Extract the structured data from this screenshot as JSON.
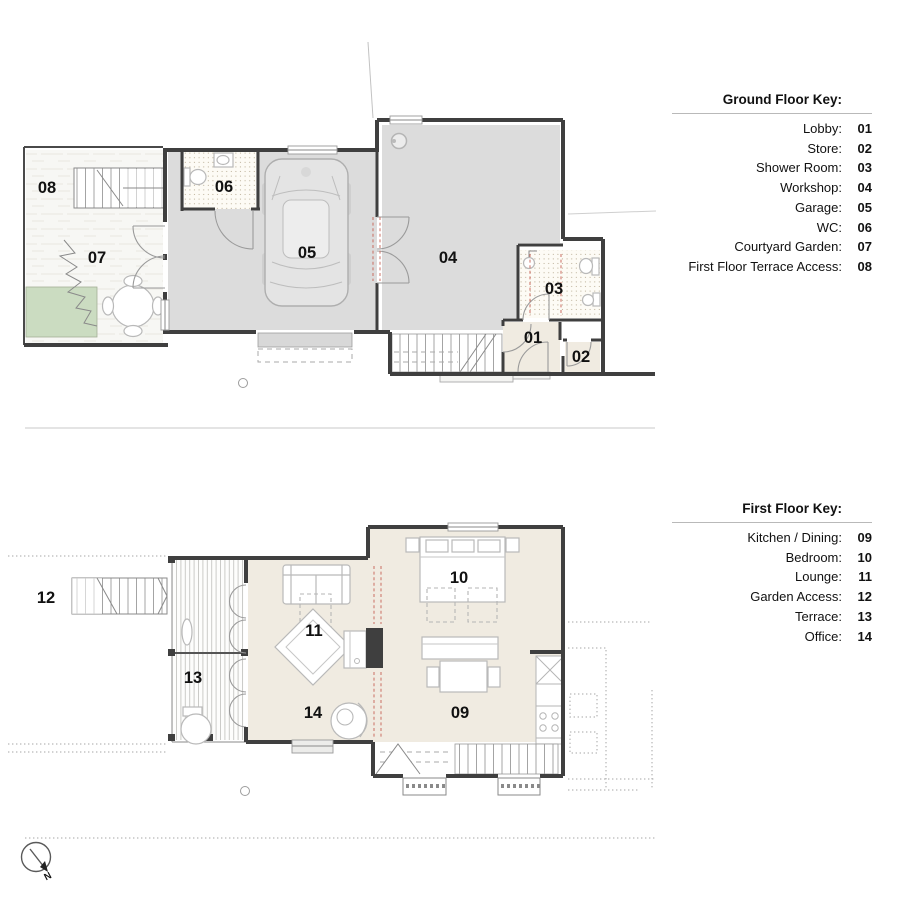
{
  "ground_floor": {
    "key_title": "Ground Floor Key:",
    "key": [
      {
        "label": "Lobby:",
        "number": "01"
      },
      {
        "label": "Store:",
        "number": "02"
      },
      {
        "label": "Shower Room:",
        "number": "03"
      },
      {
        "label": "Workshop:",
        "number": "04"
      },
      {
        "label": "Garage:",
        "number": "05"
      },
      {
        "label": "WC:",
        "number": "06"
      },
      {
        "label": "Courtyard Garden:",
        "number": "07"
      },
      {
        "label": "First Floor Terrace Access:",
        "number": "08"
      }
    ],
    "plan_labels": {
      "lobby": "01",
      "store": "02",
      "shower_room": "03",
      "workshop": "04",
      "garage": "05",
      "wc": "06",
      "courtyard_garden": "07",
      "terrace_access": "08"
    }
  },
  "first_floor": {
    "key_title": "First Floor Key:",
    "key": [
      {
        "label": "Kitchen / Dining:",
        "number": "09"
      },
      {
        "label": "Bedroom:",
        "number": "10"
      },
      {
        "label": "Lounge:",
        "number": "11"
      },
      {
        "label": "Garden Access:",
        "number": "12"
      },
      {
        "label": "Terrace:",
        "number": "13"
      },
      {
        "label": "Office:",
        "number": "14"
      }
    ],
    "plan_labels": {
      "kitchen_dining": "09",
      "bedroom": "10",
      "lounge": "11",
      "garden_access": "12",
      "terrace": "13",
      "office": "14"
    }
  },
  "north_arrow_label": "N",
  "colors": {
    "wall": "#3f3f3f",
    "floor_gray": "#dcdcdc",
    "floor_beige": "#f0ebe1",
    "garden_green": "#cbdcc1",
    "garage_door_slab": "#d8d8d8",
    "red_dash": "#c96a5e",
    "divider": "#c9c9c9"
  }
}
